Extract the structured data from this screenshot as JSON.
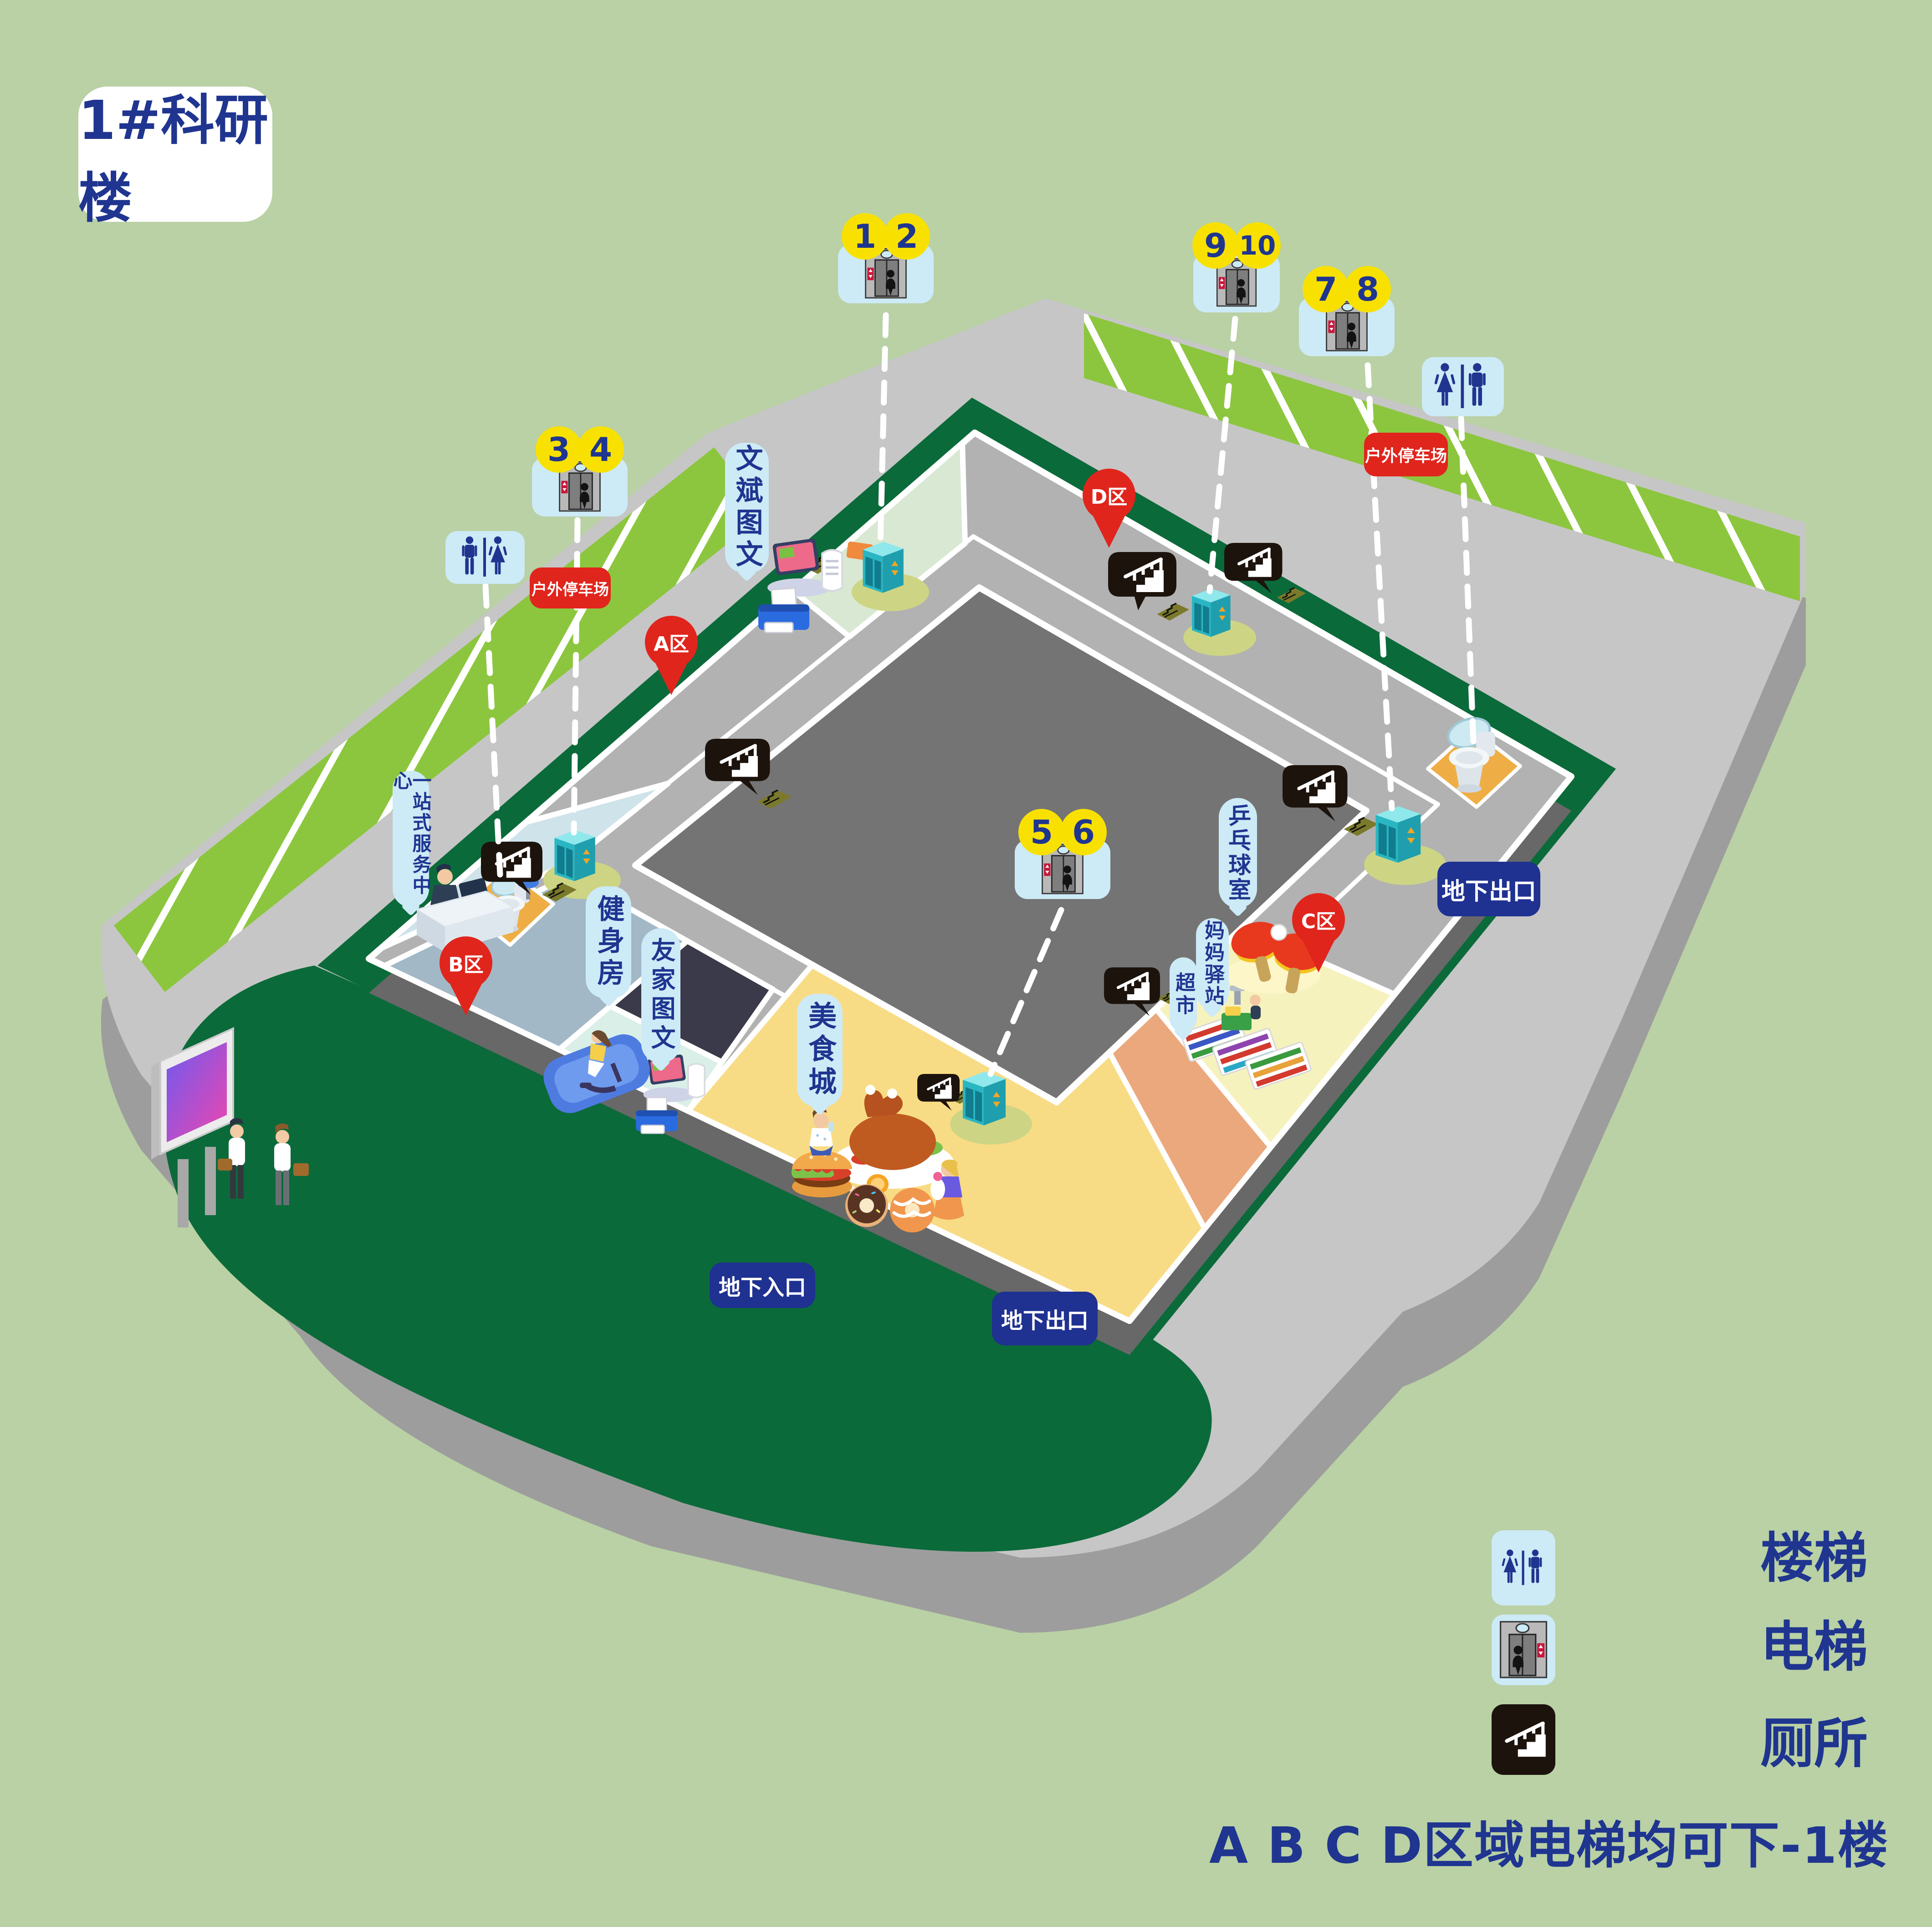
{
  "title": "1#科研楼",
  "map": {
    "elevators": [
      {
        "id": "1-2",
        "numbers": [
          "1",
          "2"
        ]
      },
      {
        "id": "3-4",
        "numbers": [
          "3",
          "4"
        ]
      },
      {
        "id": "5-6",
        "numbers": [
          "5",
          "6"
        ]
      },
      {
        "id": "7-8",
        "numbers": [
          "7",
          "8"
        ]
      },
      {
        "id": "9-10",
        "numbers": [
          "9",
          "10"
        ]
      }
    ],
    "zones": [
      {
        "label": "A区"
      },
      {
        "label": "B区"
      },
      {
        "label": "C区"
      },
      {
        "label": "D区"
      }
    ],
    "facilities": [
      {
        "id": "wenbin",
        "label": "文斌图文"
      },
      {
        "id": "service",
        "label": "一站式服务中心"
      },
      {
        "id": "gym",
        "label": "健身房"
      },
      {
        "id": "youjia",
        "label": "友家图文"
      },
      {
        "id": "food",
        "label": "美食城"
      },
      {
        "id": "market",
        "label": "超市"
      },
      {
        "id": "mama",
        "label": "妈妈驿站"
      },
      {
        "id": "pingpong",
        "label": "乒乓球室"
      }
    ],
    "parking": {
      "label": "户外停车场"
    },
    "access": {
      "exit": "地下出口",
      "entrance": "地下入口"
    }
  },
  "legend": {
    "items": [
      {
        "icon": "toilet-icon",
        "label": "厕所"
      },
      {
        "icon": "elevator-icon",
        "label": "电梯"
      },
      {
        "icon": "stairs-icon",
        "label": "楼梯"
      }
    ],
    "note": "A B C D区域电梯均可下-1楼"
  },
  "colors": {
    "navy": "#1f3590",
    "yellow": "#f8e100",
    "red": "#e0251c",
    "light_blue": "#cdeaf7",
    "deep_blue": "#1f3191",
    "bg": "#b9d1a4"
  }
}
